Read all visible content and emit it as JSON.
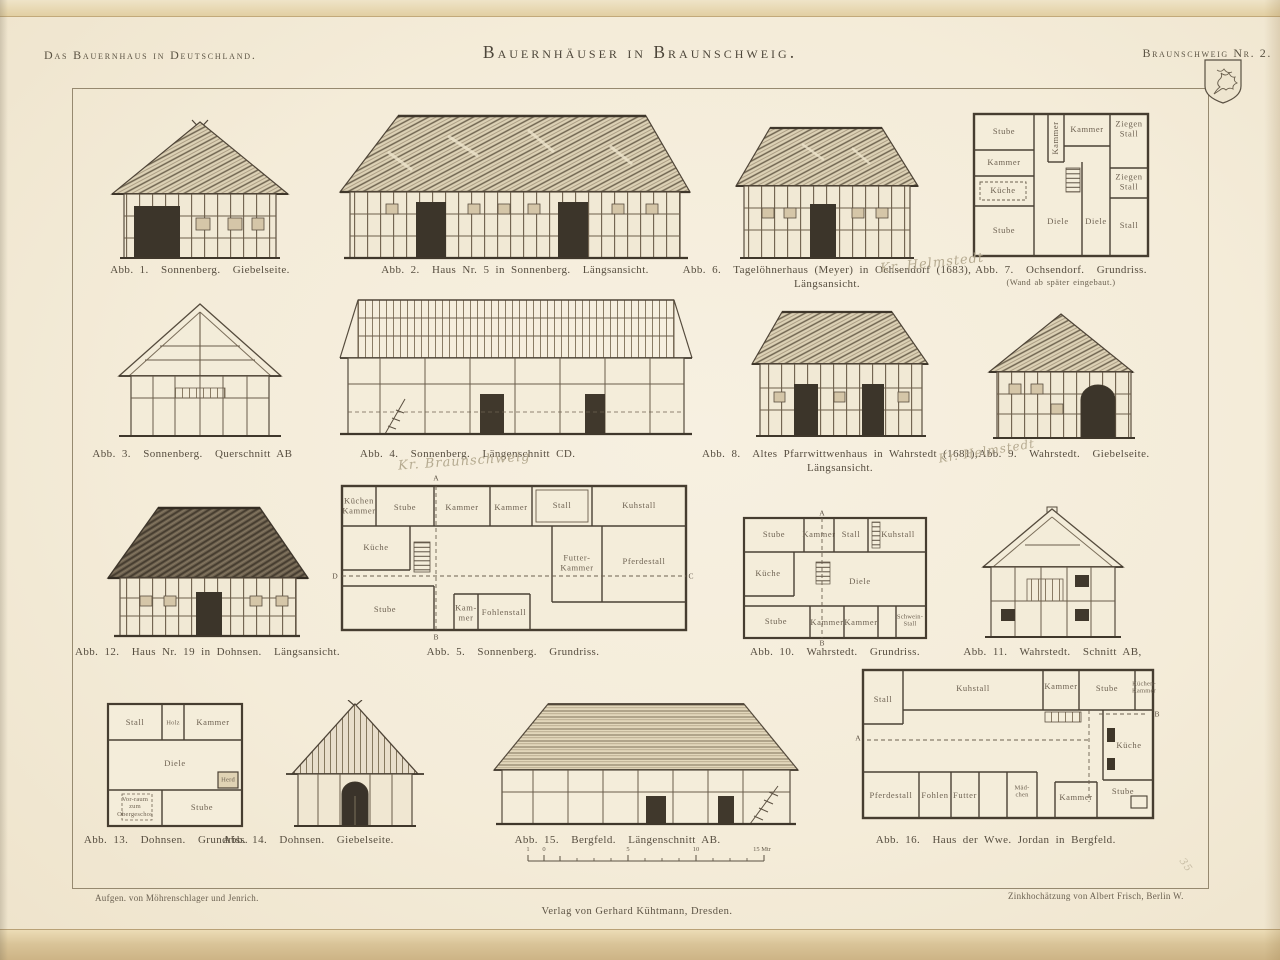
{
  "page": {
    "series_title": "Das Bauernhaus in Deutschland.",
    "plate_title": "Bauernhäuser in Braunschweig.",
    "plate_number": "Braunschweig Nr. 2.",
    "credits": {
      "surveyors": "Aufgen. von Möhrenschlager und Jenrich.",
      "etcher": "Zinkhochätzung von Albert Frisch, Berlin W.",
      "publisher": "Verlag von Gerhard Kühtmann, Dresden."
    },
    "crest_icon": "braunschweig-lion-shield"
  },
  "colors": {
    "paper": "#f5eedd",
    "ink": "#464033",
    "page_edge": "#d9c498",
    "pencil": "#b5aa90"
  },
  "scalebar": {
    "labels": [
      "1",
      "0",
      "5",
      "10",
      "15 Mtr"
    ]
  },
  "annotations": {
    "abb6_pencil": "Kr. Helmstedt",
    "abb4_pencil": "Kr. Braunschweig",
    "abb8_pencil": "Kr. Helmstedt",
    "corner_pencil": "35"
  },
  "figures": {
    "abb1": {
      "caption": "Abb. 1.  Sonnenberg.  Giebelseite."
    },
    "abb2": {
      "caption": "Abb. 2.  Haus Nr. 5 in Sonnenberg.  Längsansicht."
    },
    "abb3": {
      "caption": "Abb. 3.  Sonnenberg.  Querschnitt AB"
    },
    "abb4": {
      "caption": "Abb. 4.  Sonnenberg.  Längenschnitt CD."
    },
    "abb5": {
      "caption": "Abb. 5.  Sonnenberg.  Grundriss.",
      "rooms": [
        "Küchen\nKammer",
        "Stube",
        "Kammer",
        "Kammer",
        "Stall",
        "Kuhstall",
        "Küche",
        "Futter-\nKammer",
        "Pferdestall",
        "Stube",
        "Kam-\nmer",
        "Fohlenstall"
      ],
      "marks": [
        "A",
        "B",
        "C",
        "D"
      ]
    },
    "abb6": {
      "caption": "Abb. 6.  Tagelöhnerhaus (Meyer) in Ochsendorf (1683),",
      "caption2": "Längsansicht."
    },
    "abb7": {
      "caption": "Abb. 7.  Ochsendorf.  Grundriss.",
      "caption2": "(Wand ab später eingebaut.)",
      "rooms": [
        "Stube",
        "Kammer",
        "Küche",
        "Stube",
        "Kammer",
        "Kammer",
        "Ziegen\nStall",
        "Ziegen\nStall",
        "Stall",
        "Diele",
        "Diele"
      ]
    },
    "abb8": {
      "caption": "Abb. 8.  Altes Pfarrwittwenhaus in Wahrstedt (1681),",
      "caption2": "Längsansicht."
    },
    "abb9": {
      "caption": "Abb. 9.  Wahrstedt.  Giebelseite."
    },
    "abb10": {
      "caption": "Abb. 10.  Wahrstedt.  Grundriss.",
      "rooms": [
        "Stube",
        "Kammer",
        "Stall",
        "Kuhstall",
        "Küche",
        "Diele",
        "Stube",
        "Kammer",
        "Kammer",
        "Schwein-\nStall"
      ],
      "marks": [
        "A",
        "B"
      ]
    },
    "abb11": {
      "caption": "Abb. 11.  Wahrstedt.  Schnitt AB,"
    },
    "abb12": {
      "caption": "Abb. 12.  Haus Nr. 19 in Dohnsen.  Längsansicht."
    },
    "abb13": {
      "caption": "Abb. 13.  Dohnsen.  Grundriss.",
      "rooms": [
        "Stall",
        "Holz",
        "Kammer",
        "Diele",
        "Herd",
        "Vor-raum\nzum\nObergeschos",
        "Stube"
      ]
    },
    "abb14": {
      "caption": "Abb. 14.  Dohnsen.  Giebelseite."
    },
    "abb15": {
      "caption": "Abb. 15.  Bergfeld.  Längenschnitt AB."
    },
    "abb16": {
      "caption": "Abb. 16.  Haus der Wwe. Jordan in Bergfeld.",
      "rooms": [
        "Stall",
        "Kuhstall",
        "Kammer",
        "Stube",
        "Küchen-\nKammer",
        "Küche",
        "Stube",
        "Kammer",
        "Mäd-\nchen",
        "Futter",
        "Fohlen",
        "Pferdestall"
      ],
      "marks": [
        "A",
        "B"
      ]
    }
  }
}
